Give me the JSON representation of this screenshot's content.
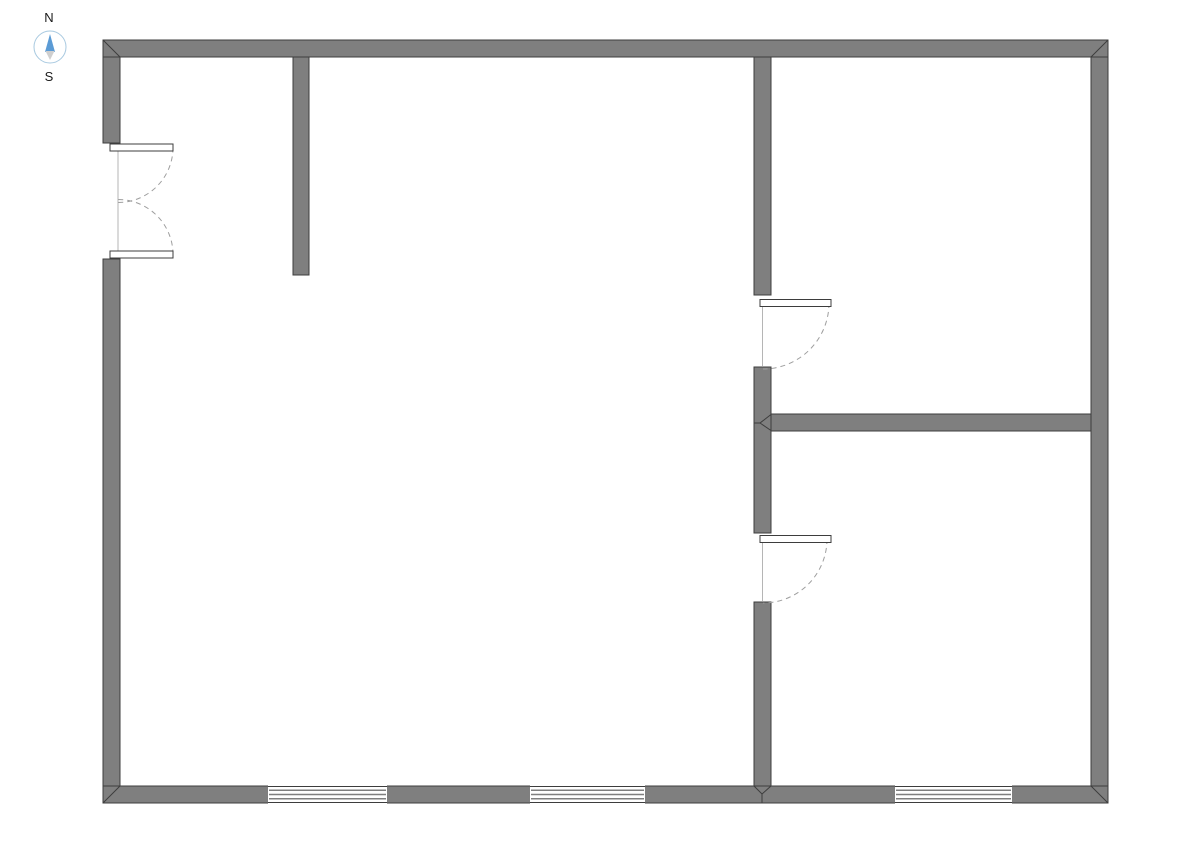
{
  "compass": {
    "north_label": "N",
    "south_label": "S",
    "ring_color": "#a8c9e0",
    "needle_color": "#5b9bd5",
    "tail_color": "#cfcfcf"
  },
  "floorplan": {
    "colors": {
      "background": "#ffffff",
      "wall_fill": "#7f7f7f",
      "wall_stroke": "#3d3d3d",
      "door_leaf_fill": "#ffffff",
      "door_frame": "#b5b5b5",
      "swing_arc": "#9e9e9e",
      "window_fill": "#ffffff",
      "window_line": "#7f7f7f"
    },
    "walls": [
      {
        "name": "exterior-wall-top",
        "x": 103,
        "y": 40,
        "w": 1005,
        "h": 17
      },
      {
        "name": "exterior-wall-bottom",
        "x": 103,
        "y": 786,
        "w": 1005,
        "h": 17
      },
      {
        "name": "exterior-wall-right",
        "x": 1091,
        "y": 57,
        "w": 17,
        "h": 729
      },
      {
        "name": "exterior-wall-left-upper",
        "x": 103,
        "y": 57,
        "w": 17,
        "h": 86
      },
      {
        "name": "exterior-wall-left-lower",
        "x": 103,
        "y": 259,
        "w": 17,
        "h": 527
      },
      {
        "name": "interior-wall-stub",
        "x": 293,
        "y": 57,
        "w": 16,
        "h": 218
      },
      {
        "name": "interior-wall-right-upper",
        "x": 754,
        "y": 57,
        "w": 17,
        "h": 238
      },
      {
        "name": "interior-wall-right-middle",
        "x": 754,
        "y": 367,
        "w": 17,
        "h": 166
      },
      {
        "name": "interior-wall-right-lower",
        "x": 754,
        "y": 602,
        "w": 17,
        "h": 184
      },
      {
        "name": "interior-wall-horizontal",
        "x": 771,
        "y": 414,
        "w": 320,
        "h": 17
      }
    ],
    "miters": [
      {
        "x1": 103,
        "y1": 40,
        "x2": 120,
        "y2": 57
      },
      {
        "x1": 1108,
        "y1": 40,
        "x2": 1091,
        "y2": 57
      },
      {
        "x1": 103,
        "y1": 803,
        "x2": 120,
        "y2": 786
      },
      {
        "x1": 1108,
        "y1": 803,
        "x2": 1091,
        "y2": 786
      },
      {
        "x1": 754,
        "y1": 423,
        "x2": 760,
        "y2": 423
      },
      {
        "x1": 760,
        "y1": 423,
        "x2": 771,
        "y2": 414.5
      },
      {
        "x1": 760,
        "y1": 423,
        "x2": 771,
        "y2": 430.5
      },
      {
        "x1": 754,
        "y1": 786,
        "x2": 762,
        "y2": 794
      },
      {
        "x1": 771,
        "y1": 786,
        "x2": 762,
        "y2": 794
      },
      {
        "x1": 762,
        "y1": 794,
        "x2": 762,
        "y2": 803
      }
    ],
    "windows": [
      {
        "name": "window-bottom-left",
        "x": 268,
        "y": 786,
        "w": 119,
        "h": 17,
        "panes": 3
      },
      {
        "name": "window-bottom-middle",
        "x": 530,
        "y": 786,
        "w": 115,
        "h": 17,
        "panes": 3
      },
      {
        "name": "window-bottom-right",
        "x": 895,
        "y": 786,
        "w": 117,
        "h": 17,
        "panes": 3
      }
    ],
    "frame_lines": [
      {
        "x1": 118,
        "y1": 151,
        "x2": 118,
        "y2": 251
      },
      {
        "x1": 762.5,
        "y1": 306.5,
        "x2": 762.5,
        "y2": 366
      },
      {
        "x1": 762.5,
        "y1": 542.5,
        "x2": 762.5,
        "y2": 601
      }
    ],
    "doors": [
      {
        "name": "entry-double-door-top",
        "leaf": {
          "x": 110,
          "y": 144,
          "w": 63,
          "h": 7
        },
        "hinge": {
          "x": 118,
          "y": 147.5
        },
        "radius": 55,
        "sweep": "cw"
      },
      {
        "name": "entry-double-door-bottom",
        "leaf": {
          "x": 110,
          "y": 251,
          "w": 63,
          "h": 7
        },
        "hinge": {
          "x": 118,
          "y": 254.5
        },
        "radius": 55,
        "sweep": "ccw"
      },
      {
        "name": "door-room-upper-right",
        "leaf": {
          "x": 760,
          "y": 299.5,
          "w": 71,
          "h": 7
        },
        "hinge": {
          "x": 763,
          "y": 303
        },
        "radius": 66,
        "sweep": "cw"
      },
      {
        "name": "door-room-lower-right",
        "leaf": {
          "x": 760,
          "y": 535.5,
          "w": 71,
          "h": 7
        },
        "hinge": {
          "x": 763,
          "y": 539
        },
        "radius": 64,
        "sweep": "cw"
      }
    ]
  }
}
